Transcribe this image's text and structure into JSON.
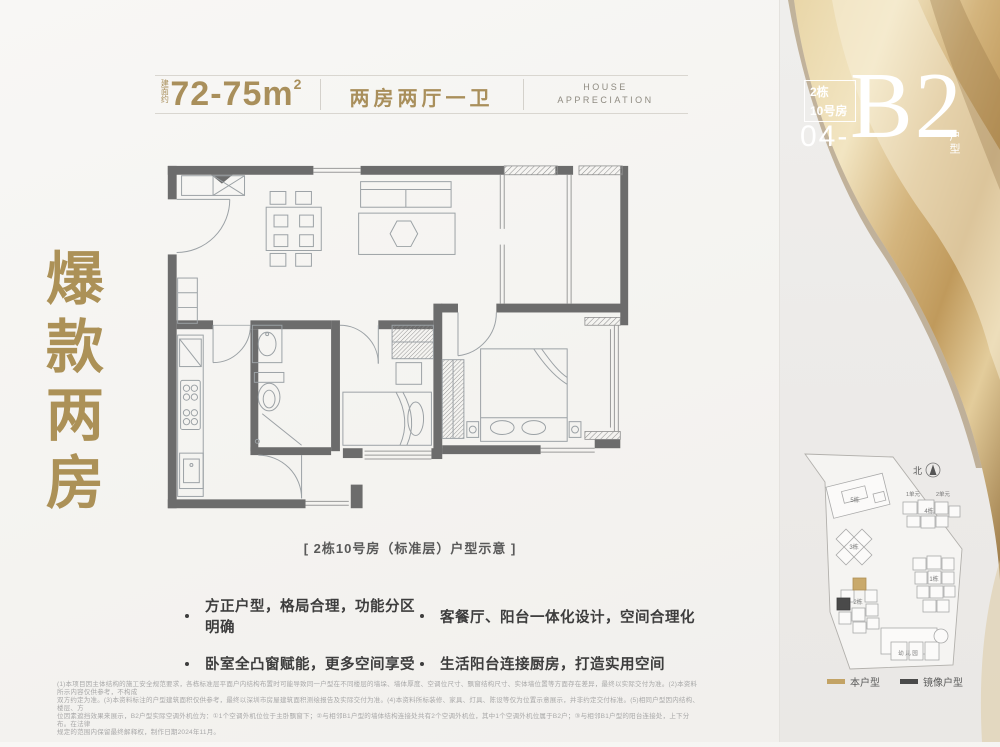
{
  "header": {
    "area_prefix": "建面约",
    "area_value": "72-75m",
    "area_sup": "2",
    "layout_label": "两房两厅一卫",
    "tagline_line1": "HOUSE",
    "tagline_line2": "APPRECIATION"
  },
  "unit_badge": {
    "building": "2栋",
    "room": "10号房",
    "number": "04-",
    "code": "B2",
    "suffix": "户型"
  },
  "slogan": {
    "text": "爆款两房"
  },
  "floorplan": {
    "caption": "[ 2栋10号房（标准层）户型示意 ]"
  },
  "highlights": [
    {
      "text": "方正户型，格局合理，功能分区明确"
    },
    {
      "text": "客餐厅、阳台一体化设计，空间合理化"
    },
    {
      "text": "卧室全凸窗赋能，更多空间享受"
    },
    {
      "text": "生活阳台连接厨房，打造实用空间"
    }
  ],
  "site_map": {
    "north_label": "北",
    "labels": {
      "b1": "1栋",
      "b2": "2栋",
      "b3": "3栋",
      "b4": "4栋",
      "b5": "5栋",
      "u1": "1单元",
      "u2": "2单元",
      "kindergarten": "幼 儿 园"
    },
    "legend": [
      {
        "label": "本户型",
        "color": "#c3a365"
      },
      {
        "label": "镜像户型",
        "color": "#4a4a4a"
      }
    ]
  },
  "disclaimer": {
    "lines": [
      "(1)本项目因主体结构的施工安全规范要求，各栋标准层平面户内结构布置时可能导致同一户型在不同楼层的墙垛、墙体厚度、空调位尺寸、飘窗结构尺寸、实体墙位置等方面存在差异，最终以实际交付为准。(2)本资料所示内容仅供参考，不构成",
      "双方约定为准。(3)本资料标注的户型建筑面积仅供参考，最终以深圳市房屋建筑面积测绘报告及实际交付为准。(4)本资料所标装修、家具、灯具、陈设等仅为位置示意展示，并非约定交付标准。(5)相同户型因内结构、楼层、方",
      "位因素遮挡效果来展示，B2户型实际空调外机位为：①1个空调外机位位于主卧飘窗下；②与相邻B1户型的墙体结构连接处共有2个空调外机位，其中1个空调外机位属于B2户；③与相邻B1户型的阳台连接处，上下分布。在法律",
      "规定的范围内保留最终解释权，制作日期2024年11月。"
    ]
  },
  "colors": {
    "gold_text": "#a98f5b",
    "slogan_gold": "#ac9157",
    "wall_gray": "#6c6c6c",
    "legend_self": "#c3a365",
    "legend_mirror": "#4a4a4a"
  }
}
